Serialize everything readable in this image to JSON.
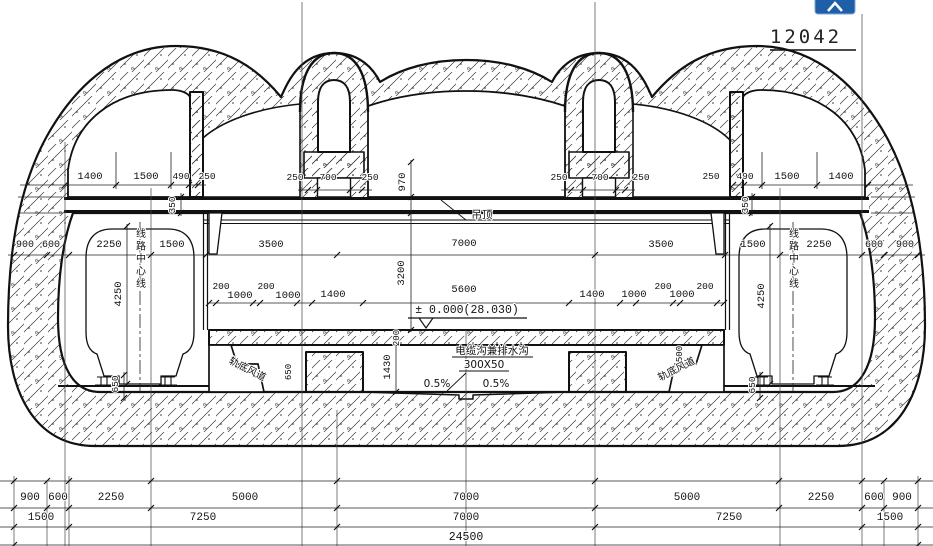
{
  "drawing": {
    "number": "12042",
    "level_mark": "± 0.000(28.030)",
    "labels": {
      "ceiling": "吊顶",
      "track_centerline_left": "线路中心线",
      "track_centerline_right": "线路中心线",
      "underrail_duct_left": "轨底风道",
      "underrail_duct_right": "轨底风道",
      "cable_trench": "电缆沟兼排水沟",
      "cable_trench_size": "300X50",
      "slope_left": "0.5%",
      "slope_right": "0.5%"
    },
    "dims": {
      "top_left": [
        "1400",
        "1500",
        "490",
        "250"
      ],
      "top_right": [
        "250",
        "490",
        "1500",
        "1400"
      ],
      "arch_left": [
        "250",
        "700",
        "250"
      ],
      "arch_right": [
        "250",
        "700",
        "250"
      ],
      "mid_left": [
        "900",
        "600",
        "2250",
        "1500",
        "3500"
      ],
      "mid_center": "7000",
      "mid_right": [
        "3500",
        "1500",
        "2250",
        "600",
        "900"
      ],
      "inner_left": [
        "200",
        "1000",
        "200",
        "1000",
        "1400"
      ],
      "inner_center": "5600",
      "inner_right": [
        "1400",
        "1000",
        "200",
        "1000",
        "200"
      ],
      "vert": {
        "v970": "970",
        "v3200": "3200",
        "v350l": "350",
        "v350r": "350",
        "v4250l": "4250",
        "v4250r": "4250",
        "v650l": "650",
        "v650r": "650",
        "v1430": "1430",
        "v200": "200",
        "v650b": "650",
        "v500": "500"
      },
      "bottom_row1": [
        "900",
        "600",
        "2250",
        "5000",
        "7000",
        "5000",
        "2250",
        "600",
        "900"
      ],
      "bottom_row2": [
        "1500",
        "7250",
        "7000",
        "7250",
        "1500"
      ],
      "bottom_row3": [
        "24500"
      ]
    }
  },
  "toolbar": {
    "app_icon": "blue-app-button"
  }
}
